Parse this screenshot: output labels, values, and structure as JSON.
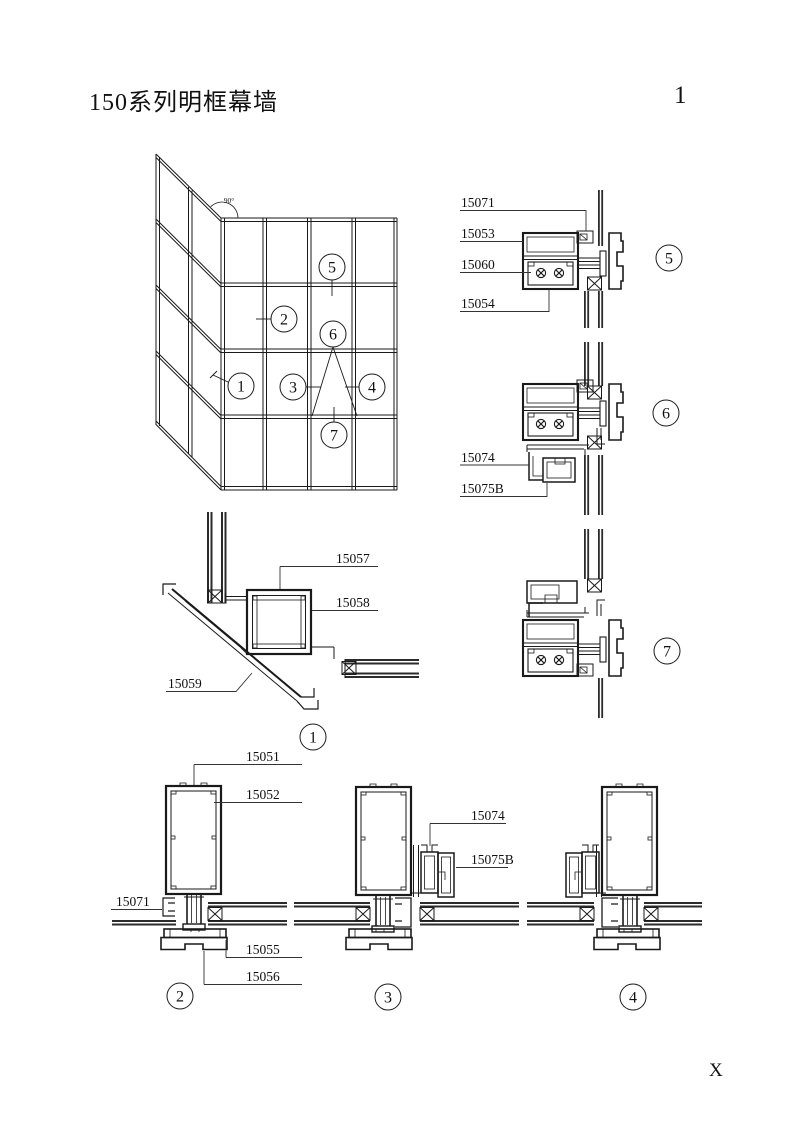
{
  "page": {
    "title": "150系列明框幕墙",
    "page_number": "1",
    "corner_mark": "X"
  },
  "elevation": {
    "angle": "90°",
    "callouts": {
      "c1": "1",
      "c2": "2",
      "c3": "3",
      "c4": "4",
      "c5": "5",
      "c6": "6",
      "c7": "7"
    }
  },
  "details": {
    "corner": {
      "number": "1",
      "p15057": "15057",
      "p15058": "15058",
      "p15059": "15059"
    },
    "d5": {
      "number": "5",
      "p15071": "15071",
      "p15053": "15053",
      "p15060": "15060",
      "p15054": "15054"
    },
    "d6": {
      "number": "6",
      "p15074": "15074",
      "p15075b": "15075B"
    },
    "d7": {
      "number": "7"
    },
    "d2": {
      "number": "2",
      "p15051": "15051",
      "p15052": "15052",
      "p15071": "15071",
      "p15055": "15055",
      "p15056": "15056"
    },
    "d3": {
      "number": "3",
      "p15074": "15074",
      "p15075b": "15075B"
    },
    "d4": {
      "number": "4"
    }
  }
}
